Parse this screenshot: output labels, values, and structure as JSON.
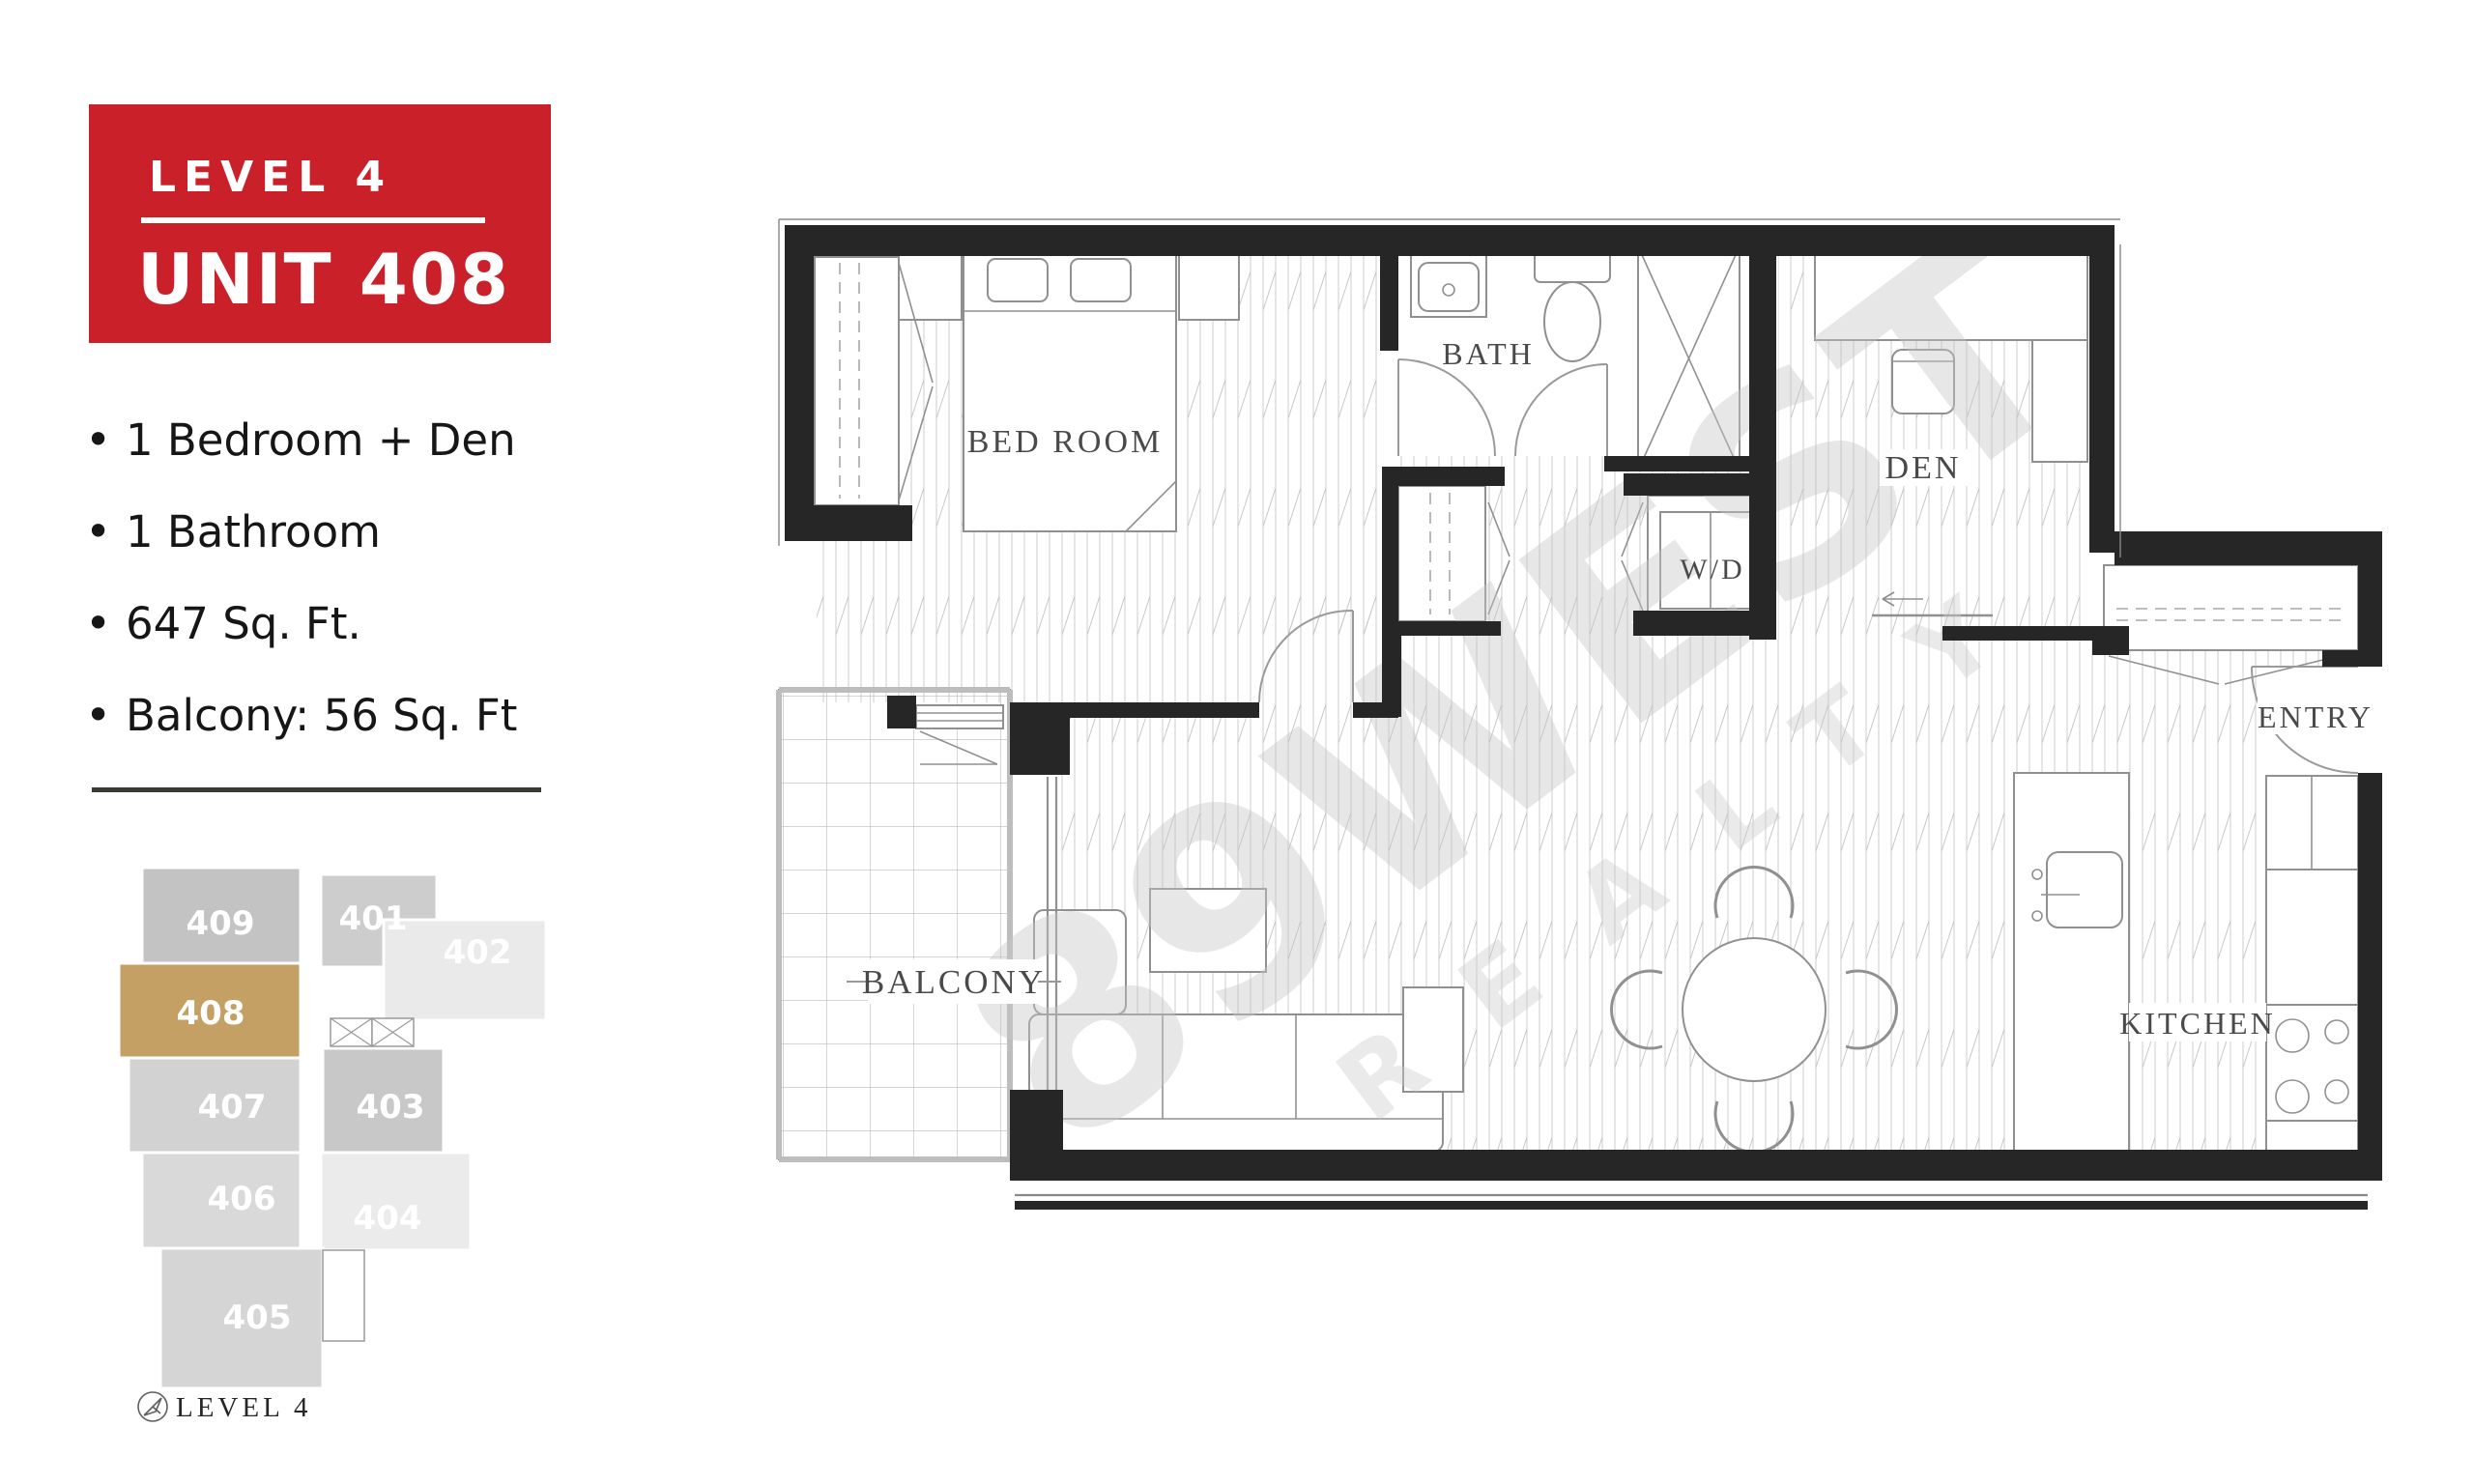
{
  "badge": {
    "level": "LEVEL 4",
    "unit": "UNIT 408"
  },
  "features": [
    "1 Bedroom + Den",
    "1 Bathroom",
    "647 Sq. Ft.",
    "Balcony: 56 Sq. Ft"
  ],
  "floorplan": {
    "rooms": [
      {
        "label": "BED ROOM"
      },
      {
        "label": "BATH"
      },
      {
        "label": "W/D"
      },
      {
        "label": "DEN"
      },
      {
        "label": "ENTRY"
      },
      {
        "label": "KITCHEN"
      },
      {
        "label": "BALCONY"
      }
    ]
  },
  "watermark": {
    "line1": "89WEST",
    "line2": "REALTY"
  },
  "keyplan": {
    "caption": "LEVEL 4",
    "highlighted_unit": "408",
    "units": [
      {
        "number": "409"
      },
      {
        "number": "401"
      },
      {
        "number": "402"
      },
      {
        "number": "408"
      },
      {
        "number": "407"
      },
      {
        "number": "403"
      },
      {
        "number": "406"
      },
      {
        "number": "404"
      },
      {
        "number": "405"
      }
    ]
  },
  "colors": {
    "badge_red": "#c9202a",
    "highlight_tan": "#c5a064"
  }
}
